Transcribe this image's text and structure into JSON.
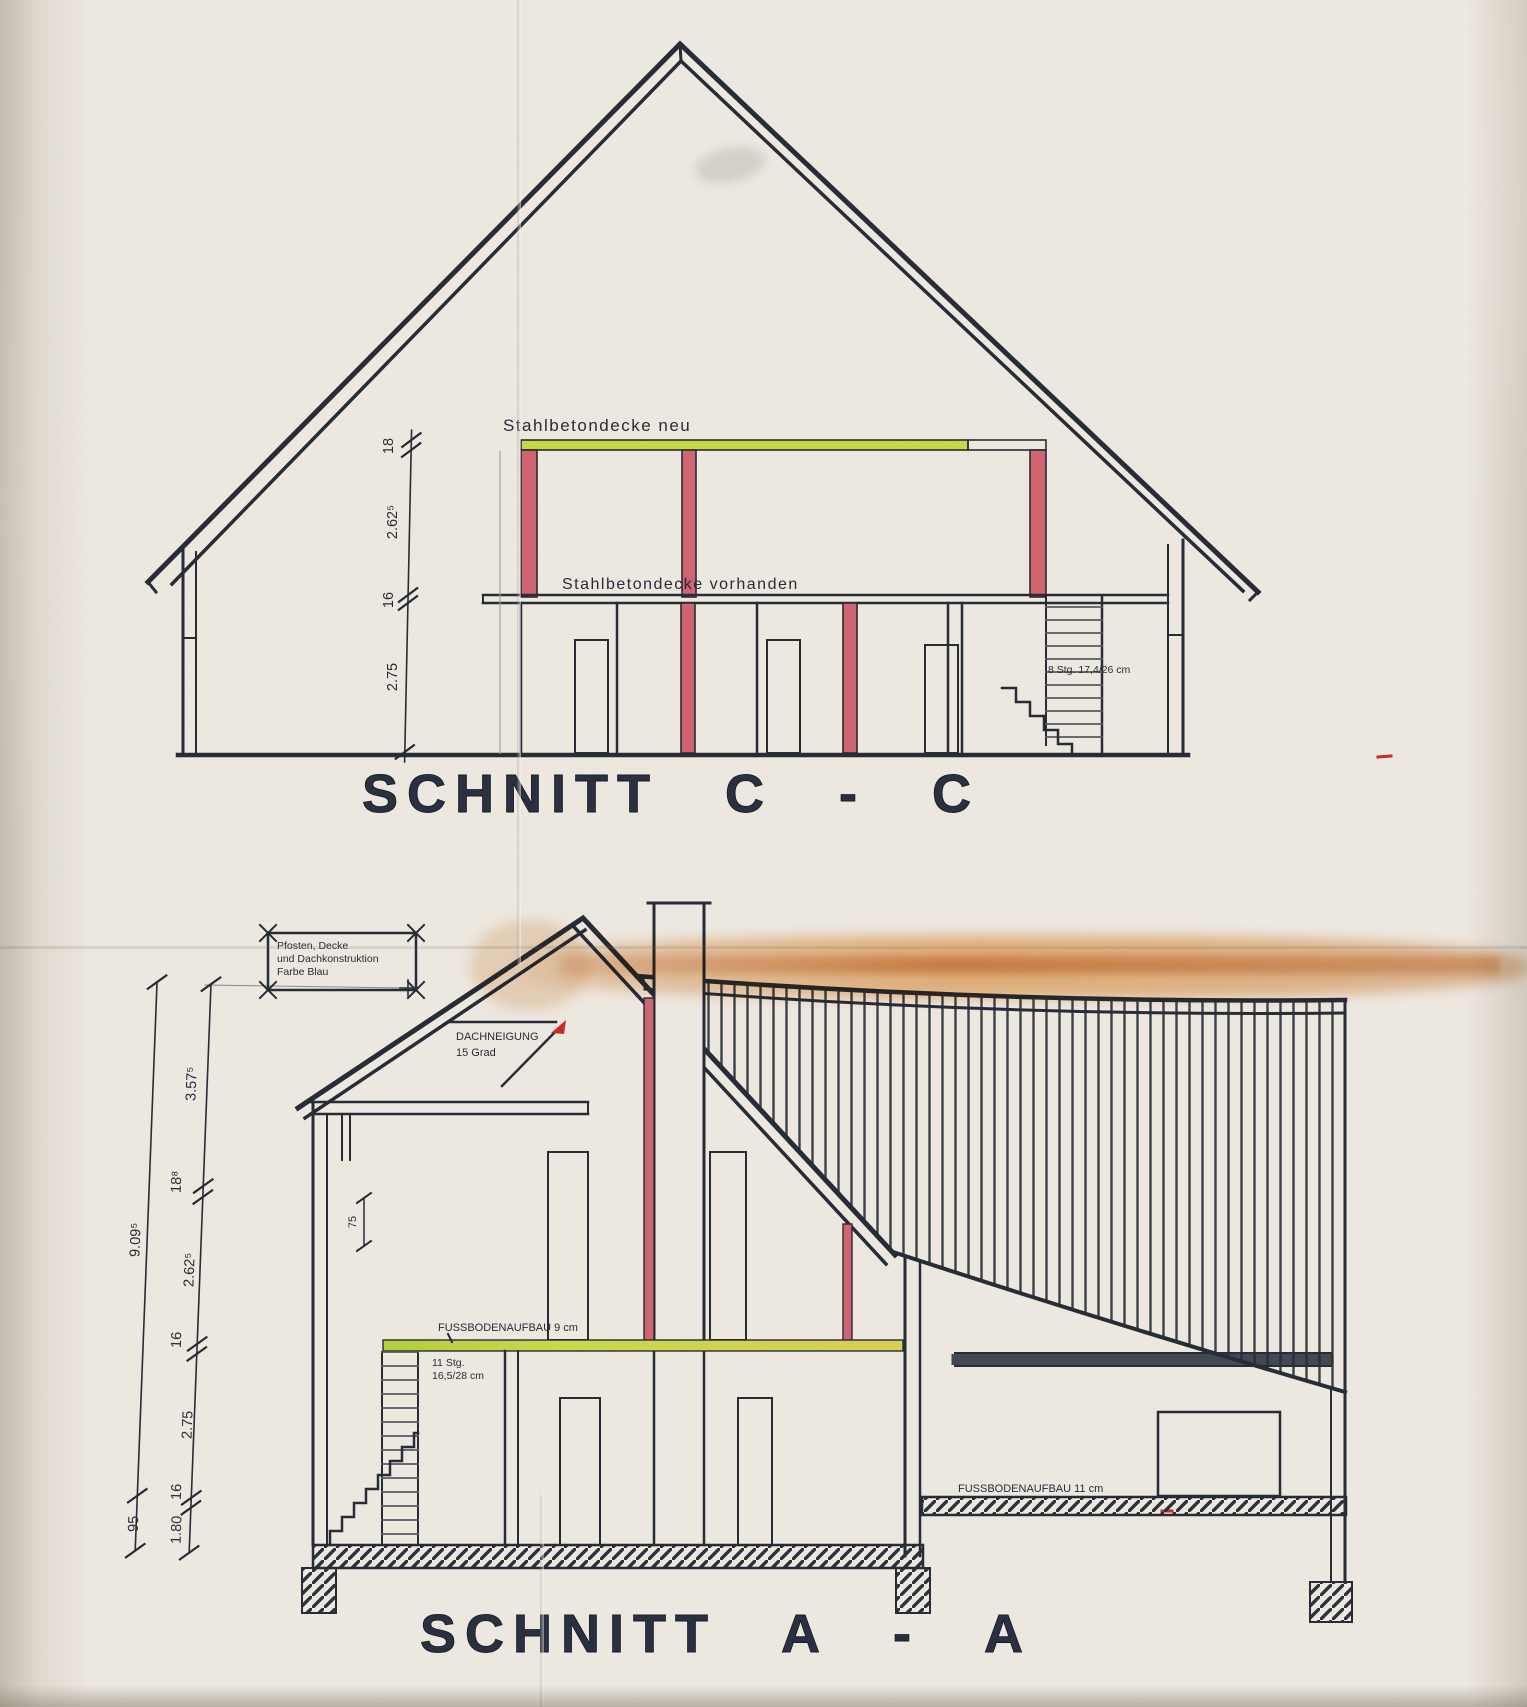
{
  "schnitt_c": {
    "title": "SCHNITT C - C",
    "labels": {
      "deck_new": "Stahlbetondecke neu",
      "deck_existing": "Stahlbetondecke vorhanden",
      "stairs": "8 Stg. 17,4/26 cm"
    },
    "dims": [
      "18",
      "2.62⁵",
      "16",
      "2.75"
    ]
  },
  "schnitt_a": {
    "title": "SCHNITT A - A",
    "labels": {
      "pitch1": "DACHNEIGUNG",
      "pitch2": "15 Grad",
      "floor_upper": "FUSSBODENAUFBAU 9 cm",
      "floor_lower": "FUSSBODENAUFBAU 11 cm",
      "stairs1": "11 Stg.",
      "stairs2": "16,5/28 cm",
      "level_dim": "75"
    },
    "note": [
      "Pfosten, Decke",
      "und Dachkonstruktion",
      "Farbe Blau"
    ],
    "dims_outer": [
      "9.09⁵",
      "95"
    ],
    "dims_inner": [
      "3.57⁵",
      "18⁸",
      "2.62⁵",
      "16",
      "2.75",
      "16",
      "1.80"
    ]
  },
  "colors": {
    "ink": "#272c37",
    "highlight_red": "#cf6570",
    "highlight_green": "#c6d748",
    "stain_orange": "#dd8f45",
    "marker_red": "#c03226"
  }
}
